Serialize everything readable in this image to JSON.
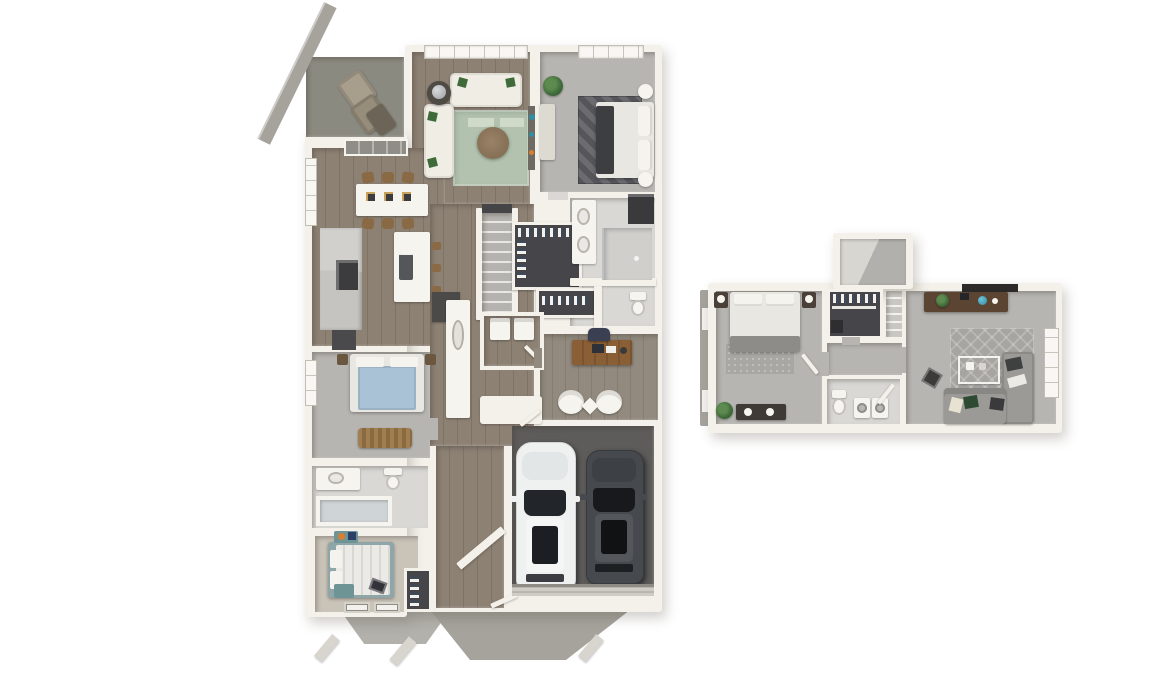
{
  "scene": {
    "type": "3d-rendered-floor-plan",
    "background": "#ffffff",
    "floor_plans": [
      {
        "id": "main-level",
        "position": "left",
        "rooms": [
          {
            "name": "patio",
            "furniture": [
              "lounge-chair",
              "lounge-chair",
              "side-table",
              "diagonal-walkway"
            ]
          },
          {
            "name": "living-room",
            "furniture": [
              "white-sofa",
              "white-loveseat",
              "round-coffee-table",
              "sage-area-rug",
              "side-table-with-globe",
              "top-wall-windows"
            ]
          },
          {
            "name": "primary-bedroom",
            "furniture": [
              "bed-with-dark-runner",
              "round-poufs",
              "dresser",
              "potted-plant",
              "patterned-rug",
              "window"
            ]
          },
          {
            "name": "primary-bathroom",
            "furniture": [
              "double-vanity",
              "walk-in-shower",
              "toilet-room",
              "dark-linen-nook"
            ]
          },
          {
            "name": "walk-in-closet",
            "furniture": [
              "hanging-clothes"
            ]
          },
          {
            "name": "hall-closet",
            "furniture": [
              "hanging-clothes"
            ]
          },
          {
            "name": "dining-area",
            "furniture": [
              "white-dining-table",
              "six-wood-chairs",
              "place-settings",
              "sliding-patio-door",
              "window"
            ]
          },
          {
            "name": "kitchen",
            "furniture": [
              "wall-counter",
              "cooktop",
              "refrigerator",
              "island-with-sink",
              "bar-stools"
            ]
          },
          {
            "name": "stairs",
            "furniture": []
          },
          {
            "name": "den-nook",
            "furniture": [
              "armchair",
              "armchair",
              "door"
            ]
          },
          {
            "name": "bedroom-2",
            "furniture": [
              "blue-bed",
              "nightstands",
              "wicker-bench",
              "window"
            ]
          },
          {
            "name": "bathroom-2",
            "furniture": [
              "vanity-with-sink",
              "toilet",
              "tub-shower"
            ]
          },
          {
            "name": "bedroom-3",
            "furniture": [
              "striped-bed",
              "teal-nightstands",
              "closet-shelves",
              "bottom-wall-windows"
            ]
          },
          {
            "name": "office-den",
            "furniture": [
              "wood-desk",
              "desk-chair",
              "barrel-chair",
              "barrel-chair",
              "diamond-side-table"
            ]
          },
          {
            "name": "entry-hall",
            "furniture": [
              "utility-cabinet",
              "dark-cabinet",
              "front-door"
            ]
          },
          {
            "name": "garage",
            "furniture": [
              "white-suv",
              "dark-sedan",
              "garage-door"
            ]
          }
        ]
      },
      {
        "id": "upper-level",
        "position": "right",
        "rooms": [
          {
            "name": "bedroom",
            "furniture": [
              "bed",
              "nightstand-with-lamp",
              "nightstand-with-lamp",
              "textured-rug",
              "dresser",
              "potted-plant",
              "door"
            ]
          },
          {
            "name": "walk-in-closet",
            "furniture": [
              "hanging-clothes",
              "storage-box"
            ]
          },
          {
            "name": "stairwell",
            "furniture": [
              "sloped-ceiling-plane",
              "stair-flight"
            ]
          },
          {
            "name": "hallway",
            "furniture": []
          },
          {
            "name": "bathroom",
            "furniture": [
              "toilet",
              "washer",
              "dryer",
              "door"
            ]
          },
          {
            "name": "bonus-room",
            "furniture": [
              "sectional-sofa",
              "throw-pillows",
              "wireframe-coffee-table",
              "media-console",
              "dark-wall-shelf",
              "damask-rug",
              "floor-tray",
              "window"
            ]
          }
        ]
      }
    ]
  },
  "palette": {
    "wall": "#f4f1ea",
    "cream": "#f6f4ef",
    "wood": "#8d8174",
    "wood2": "#7f7366",
    "office": "#928a7e",
    "carpet": "#b7b5b1",
    "carpet3": "#c9c3b8",
    "tile": "#d9d8d5",
    "dark": "#46464a",
    "stairs": "#b5b3af",
    "garage": "#5e5c5a",
    "patio": "#8b8a80",
    "walk": "#a5a39c",
    "ruggreen": "#b2c2ae",
    "ruggreen2": "#cfdac9",
    "sofa": "#f0ede5",
    "sofagray": "#9c9a96",
    "bed": "#e9e7e2",
    "bedband": "#3d3e40",
    "bedblue": "#a9c2d6",
    "bedteal": "#8fa6a8",
    "wooddesk": "#8a5f35",
    "woodconsole": "#5c4432",
    "car": "#eff1f1",
    "cardark": "#464a4f",
    "glass": "#22262b",
    "plant": "#3f6b3a",
    "teal": "#2e8fa3",
    "orange": "#d97f2e"
  }
}
